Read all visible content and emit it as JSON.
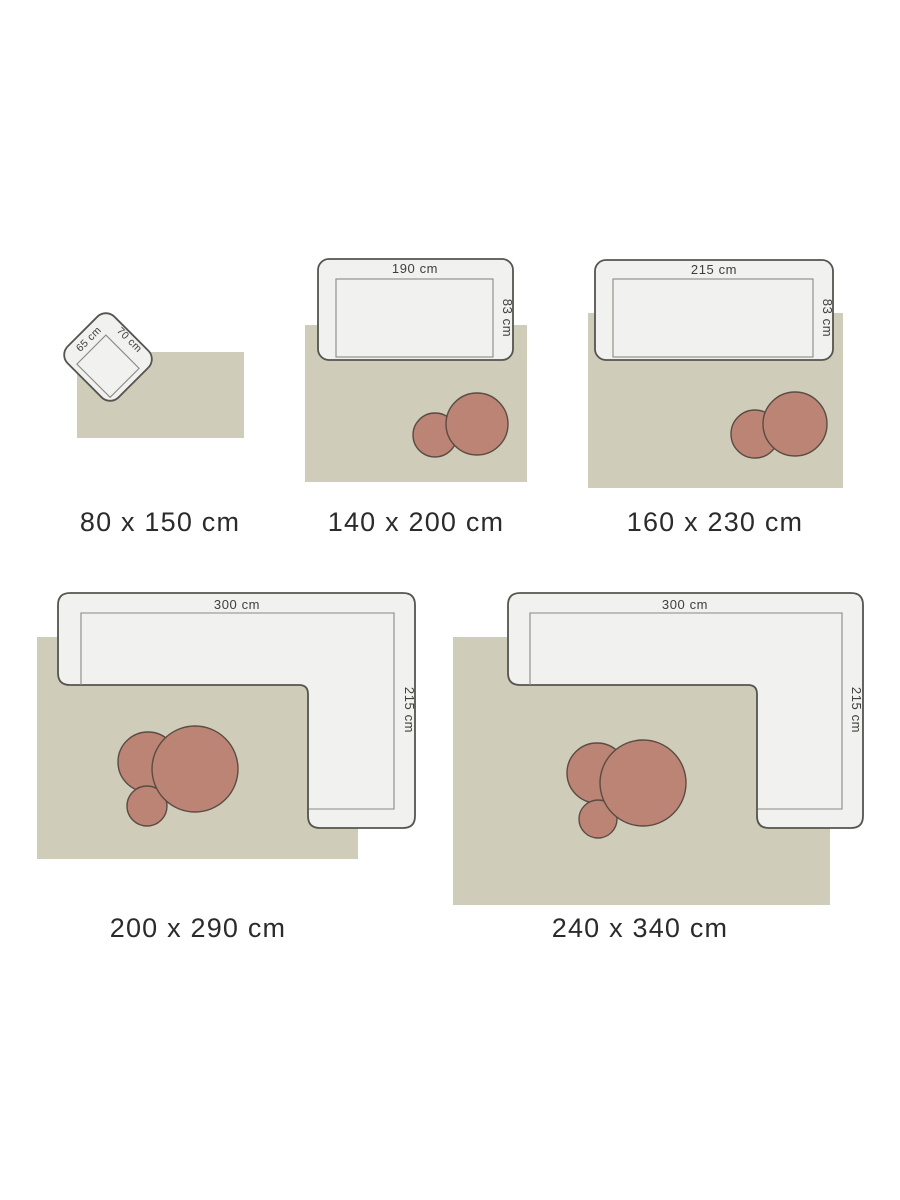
{
  "canvas": {
    "background": "#ffffff"
  },
  "colors": {
    "rug": "#cfccba",
    "furniture_fill": "#f1f1ef",
    "furniture_stroke": "#55544e",
    "seat_outline": "#8b8a83",
    "coffee_table_fill": "#bb8475",
    "coffee_table_stroke": "#5a4c43",
    "dimension_text": "#3f3e3a",
    "caption_text": "#2b2b2b"
  },
  "items": [
    {
      "caption": "80 x 150 cm",
      "furniture": "armchair",
      "labels": {
        "width": "65 cm",
        "depth": "70 cm"
      }
    },
    {
      "caption": "140 x 200 cm",
      "furniture": "sofa",
      "labels": {
        "width": "190 cm",
        "depth": "83 cm"
      }
    },
    {
      "caption": "160 x 230 cm",
      "furniture": "sofa",
      "labels": {
        "width": "215 cm",
        "depth": "83 cm"
      }
    },
    {
      "caption": "200 x 290 cm",
      "furniture": "corner-sofa",
      "labels": {
        "width": "300 cm",
        "depth": "215 cm"
      }
    },
    {
      "caption": "240 x 340 cm",
      "furniture": "corner-sofa",
      "labels": {
        "width": "300 cm",
        "depth": "215 cm"
      }
    }
  ]
}
